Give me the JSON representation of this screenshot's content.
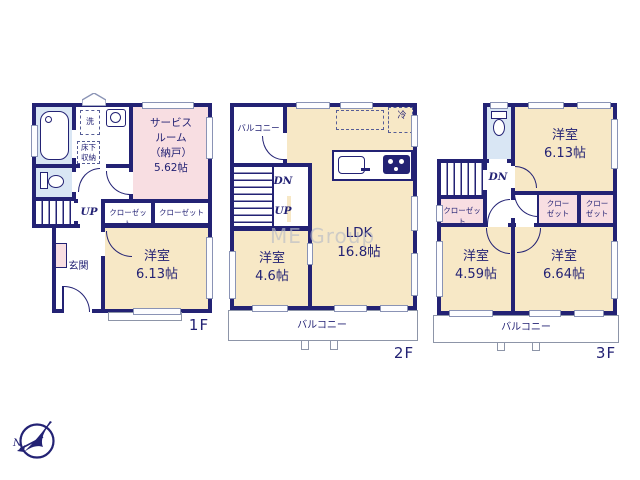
{
  "watermark": "ME Group",
  "compass": {
    "north_label": "N"
  },
  "colors": {
    "wall": "#232274",
    "cream": "#f7e8c6",
    "pink": "#f8dee2",
    "blue": "#d9e6f4",
    "winborder": "#8a93b5",
    "balcony": "#8d95a8",
    "watermark": "#b9bdc6"
  },
  "floor1": {
    "label": "1F",
    "wash": "洗",
    "underfloor": "床下\n収納",
    "service": "サービス\nルーム\n（納戸）\n5.62帖",
    "up": "UP",
    "closet1": "クローゼット",
    "closet2": "クローゼット",
    "entrance": "玄関",
    "western": "洋室\n6.13帖"
  },
  "floor2": {
    "label": "2F",
    "balcony_top": "バルコニー",
    "fridge": "冷",
    "dn": "DN",
    "up": "UP",
    "western": "洋室\n4.6帖",
    "ldk": "LDK\n16.8帖",
    "balcony_bottom": "バルコニー"
  },
  "floor3": {
    "label": "3F",
    "western1": "洋室\n6.13帖",
    "dn": "DN",
    "closet_left": "クローゼット",
    "closet_mid": "クロー\nゼット",
    "closet_right": "クロー\nゼット",
    "western2": "洋室\n4.59帖",
    "western3": "洋室\n6.64帖",
    "balcony": "バルコニー"
  }
}
